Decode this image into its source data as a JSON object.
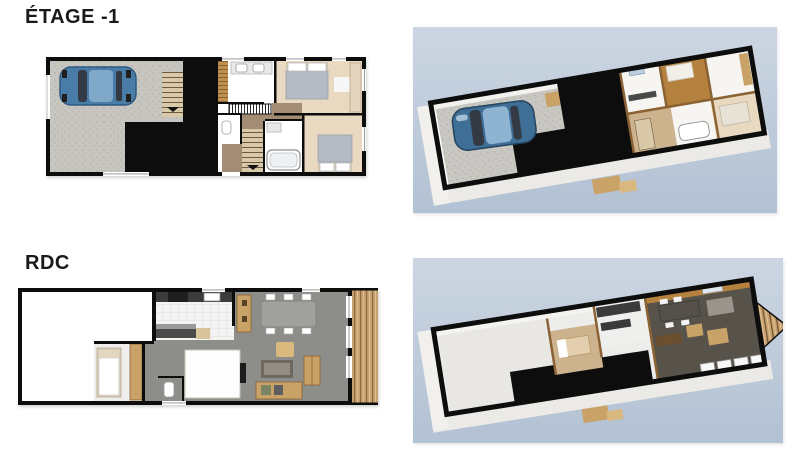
{
  "document": {
    "type": "real-estate floor plan sheet",
    "floors": [
      {
        "title": "ÉTAGE -1",
        "plan2d": "2D plan: garage with car (left), unexcavated black core, stairs, two bedrooms and two bathrooms with hallway (right)",
        "view3d": "3D aerial cutaway of basement level on blue background"
      },
      {
        "title": "RDC",
        "plan2d": "2D plan: empty room (left), small bedroom, kitchen, WC, living-dining room, wooden terrace (right)",
        "view3d": "3D aerial cutaway of ground floor on blue background"
      }
    ]
  },
  "colors": {
    "page_bg": "#ffffff",
    "title_text": "#1a1a1a",
    "wall_black": "#0d0d0d",
    "sky_blue_top": "#ccd6e2",
    "sky_blue_bottom": "#b2c1d3",
    "concrete": "#c7c5c0",
    "car_body": "#4a7ca8",
    "car_roof": "#7fa8c9",
    "car_glass": "#333a44",
    "floor_beige": "#e9d9c0",
    "floor_brown": "#a28d74",
    "floor_gray": "#8d8d89",
    "wood_dark": "#8a6234",
    "counter_dark": "#3b3b3b",
    "furniture_tan": "#c9a267",
    "bed_gray": "#b6bac2",
    "white": "#ffffff",
    "wall_white_3d": "#eceae6",
    "interior_wood_wall": "#b5813f",
    "dark_floor": "#57534b"
  }
}
